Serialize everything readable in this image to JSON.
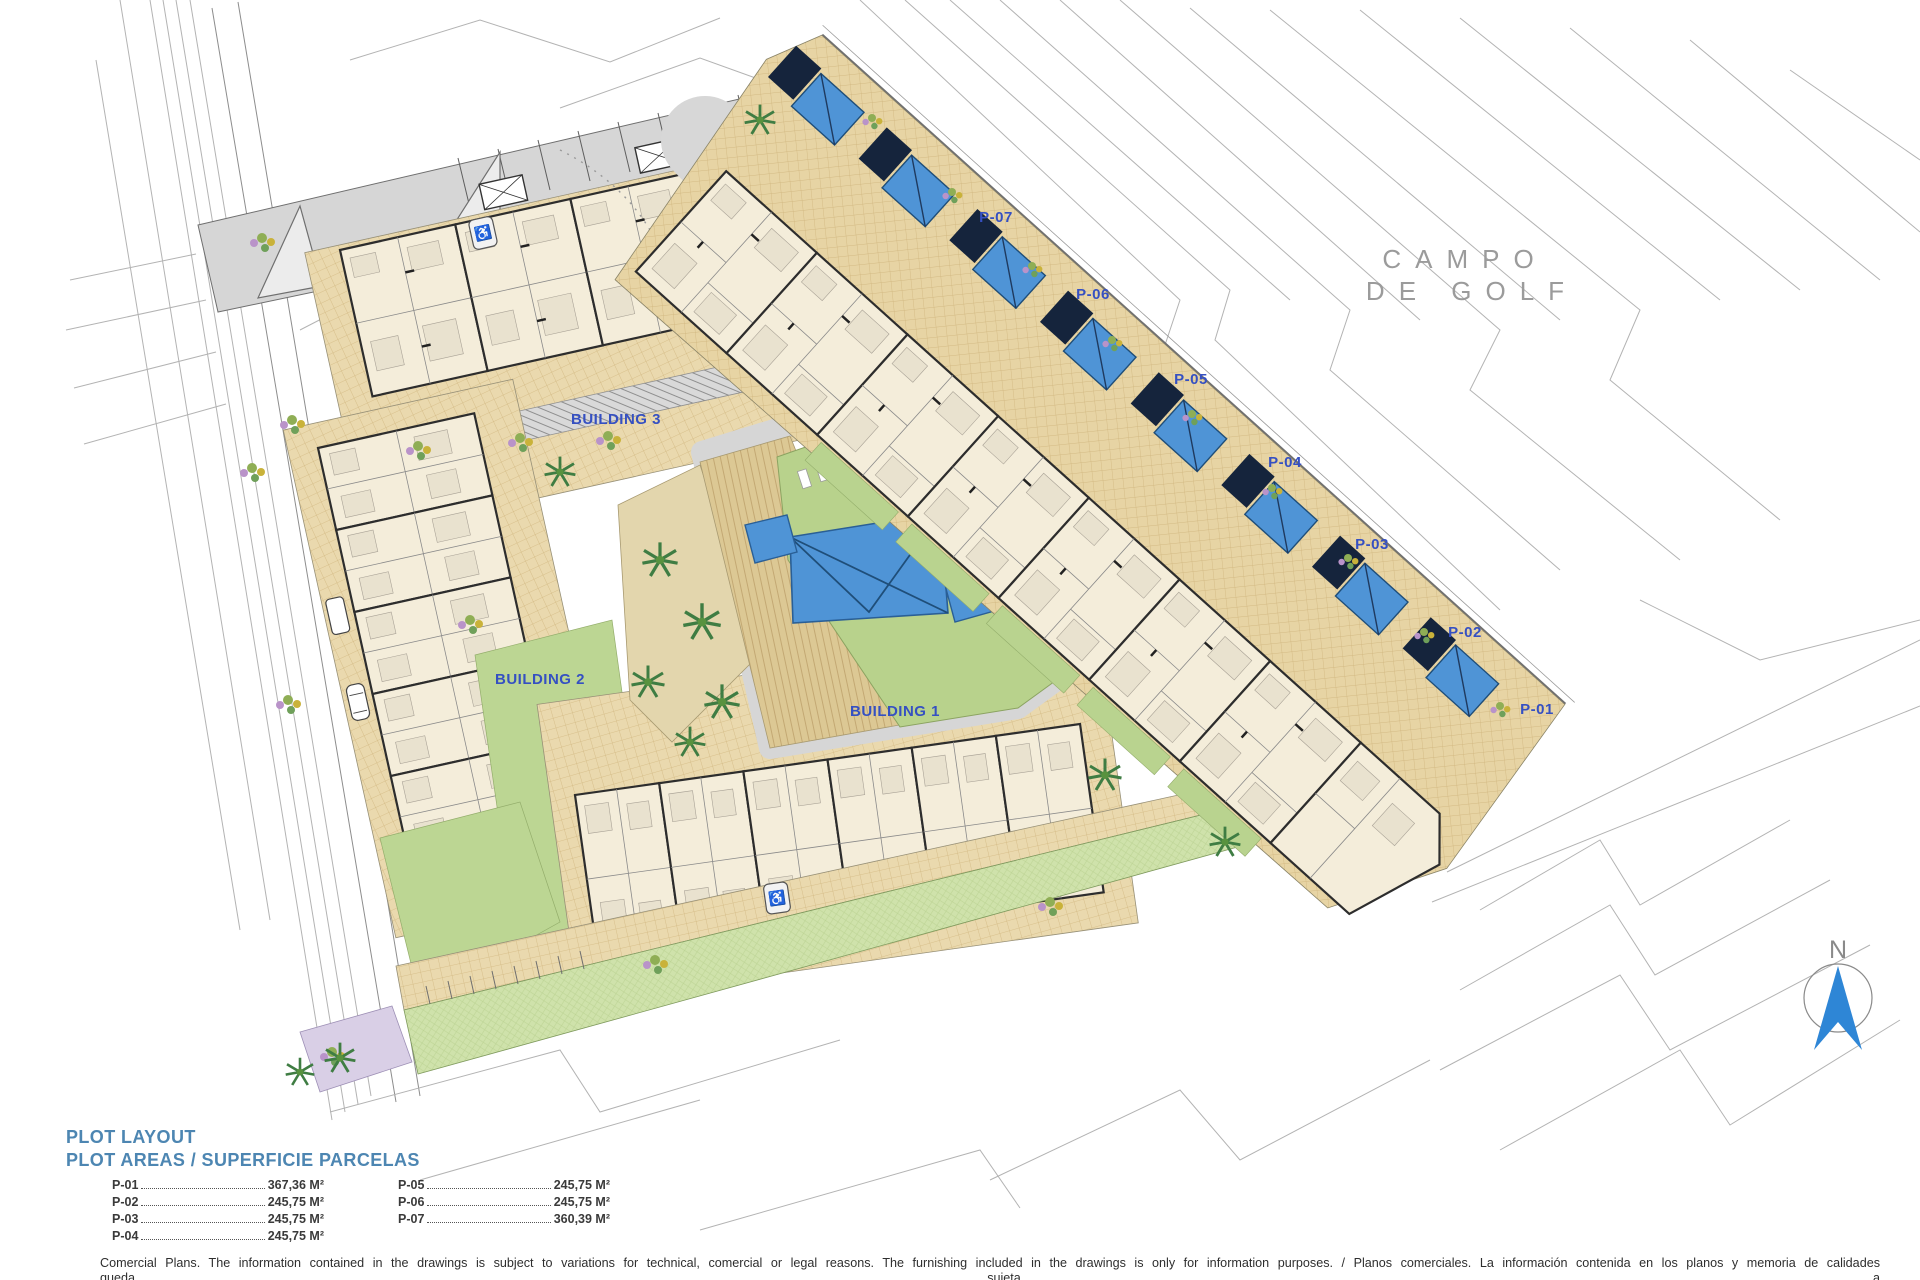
{
  "plan": {
    "buildings": [
      {
        "label": "BUILDING 3"
      },
      {
        "label": "BUILDING 2"
      },
      {
        "label": "BUILDING 1"
      }
    ],
    "plots": [
      {
        "label": "P-07"
      },
      {
        "label": "P-06"
      },
      {
        "label": "P-05"
      },
      {
        "label": "P-04"
      },
      {
        "label": "P-03"
      },
      {
        "label": "P-02"
      },
      {
        "label": "P-01"
      }
    ],
    "golf_course": {
      "line1": "CAMPO",
      "line2": "DE GOLF"
    },
    "north_arrow_label": "N",
    "colors": {
      "paving_tan": "#e9d7ab",
      "pool_blue": "#4f94d6",
      "lawn_green": "#b8d28c",
      "label_blue": "#3550c2",
      "road_gray": "#d6d6d6",
      "pergola_navy": "#15243c"
    }
  },
  "legend": {
    "title": "PLOT LAYOUT",
    "subtitle": "PLOT AREAS / SUPERFICIE PARCELAS",
    "left_column": [
      {
        "id": "P-01",
        "area": "367,36 M²"
      },
      {
        "id": "P-02",
        "area": "245,75 M²"
      },
      {
        "id": "P-03",
        "area": "245,75 M²"
      },
      {
        "id": "P-04",
        "area": "245,75 M²"
      }
    ],
    "right_column": [
      {
        "id": "P-05",
        "area": "245,75 M²"
      },
      {
        "id": "P-06",
        "area": "245,75 M²"
      },
      {
        "id": "P-07",
        "area": "360,39 M²"
      }
    ]
  },
  "footer": {
    "line1": "Comercial Plans. The information contained in the drawings is subject to variations for technical, comercial or legal reasons. The furnishing included in the drawings is only for information purposes. / Planos comerciales. La información contenida en los planos y memoria de calidades queda sujeta a",
    "line2": "variaciones por motivos técnicos, comerciales o legales. El mobiliario incluido en los planos es únicamente a título informativo."
  }
}
